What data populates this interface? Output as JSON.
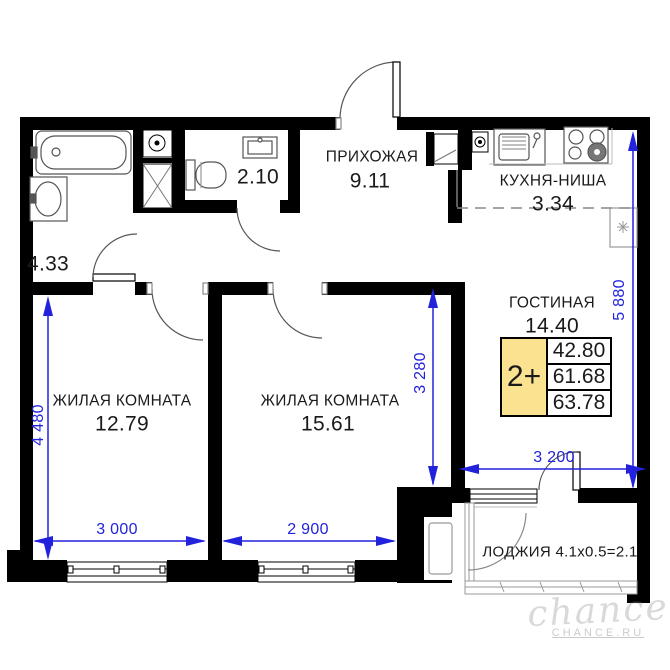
{
  "rooms": {
    "hallway": {
      "name": "ПРИХОЖАЯ",
      "area": "9.11"
    },
    "kitchen": {
      "name": "КУХНЯ-НИША",
      "area": "3.34"
    },
    "living": {
      "name": "ГОСТИНАЯ",
      "area": "14.40"
    },
    "bedroom1": {
      "name": "ЖИЛАЯ КОМНАТА",
      "area": "12.79"
    },
    "bedroom2": {
      "name": "ЖИЛАЯ КОМНАТА",
      "area": "15.61"
    },
    "bathroom": {
      "area": "4.33"
    },
    "wc": {
      "area": "2.10"
    },
    "loggia": {
      "label": "ЛОДЖИЯ 4.1х0.5=2.1"
    }
  },
  "dimensions": {
    "bedroom1_height": "4 480",
    "bedroom1_width": "3 000",
    "bedroom2_width": "2 900",
    "bedroom2_height": "3 280",
    "right_height": "5 880",
    "living_width": "3 200"
  },
  "badge": {
    "type": "2+",
    "values": [
      "42.80",
      "61.68",
      "63.78"
    ]
  },
  "watermark": {
    "script": "chance",
    "caption": "CHANCE.RU"
  },
  "colors": {
    "wall": "#000000",
    "dimension": "#2222dd",
    "badge_fill": "#fbe291"
  }
}
